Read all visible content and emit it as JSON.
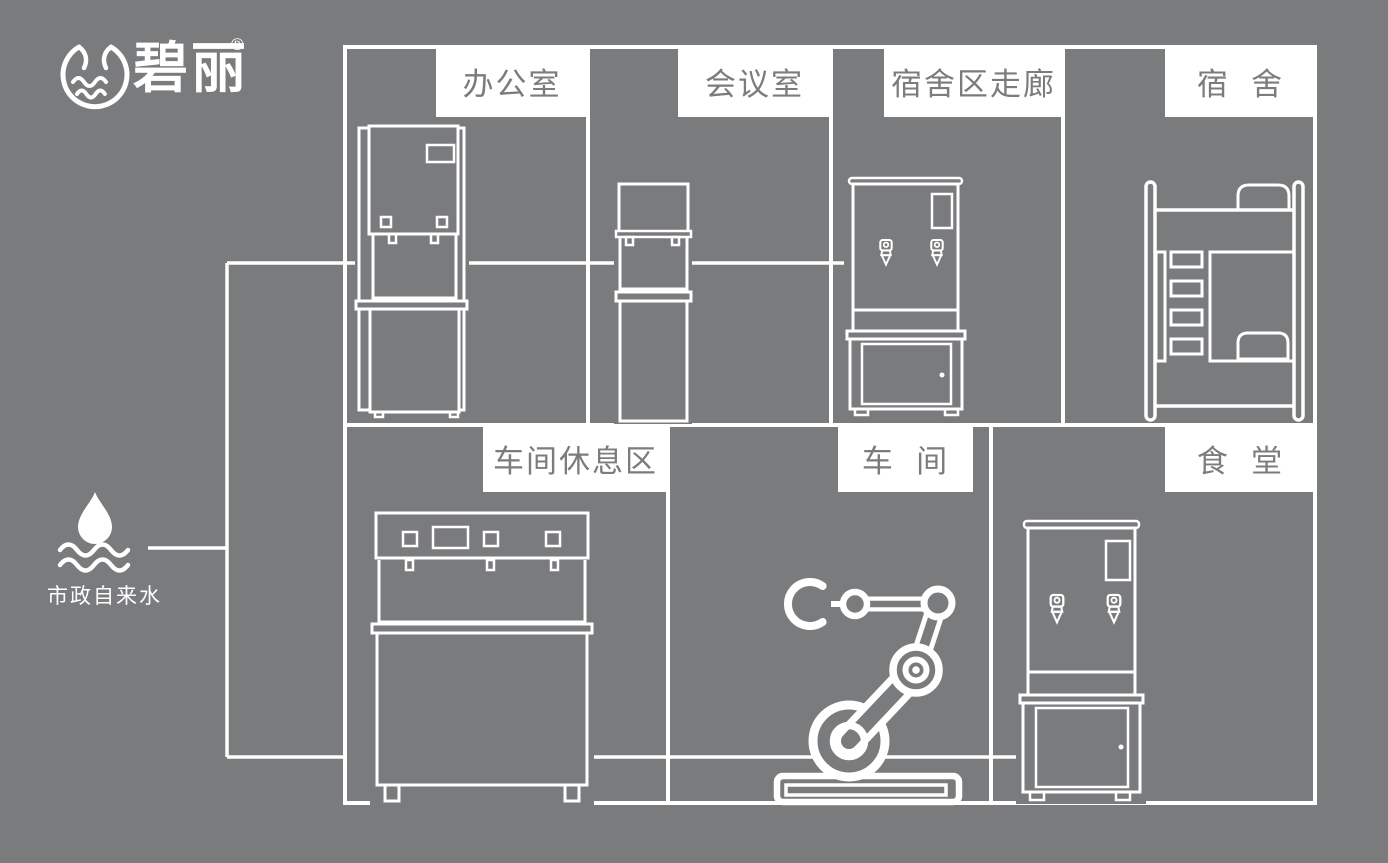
{
  "colors": {
    "background": "#7a7b7d",
    "line": "#ffffff",
    "label_bg": "#ffffff",
    "label_text": "#7b7c7e"
  },
  "logo": {
    "brand": "碧丽",
    "registered_mark": "®",
    "icon": "water-cup-logo-icon"
  },
  "water_source": {
    "label": "市政自来水",
    "icon": "water-drop-waves-icon"
  },
  "rooms": [
    {
      "id": "office",
      "label": "办公室",
      "icon": "floor-standing-dispenser-icon"
    },
    {
      "id": "meeting-room",
      "label": "会议室",
      "icon": "slim-dispenser-icon"
    },
    {
      "id": "dorm-corridor",
      "label": "宿舍区走廊",
      "icon": "water-boiler-with-stand-icon"
    },
    {
      "id": "dormitory",
      "label": "宿  舍",
      "icon": "bunk-bed-icon"
    },
    {
      "id": "workshop-rest-area",
      "label": "车间休息区",
      "icon": "wide-multi-tap-dispenser-icon"
    },
    {
      "id": "workshop",
      "label": "车  间",
      "icon": "robot-arm-icon"
    },
    {
      "id": "canteen",
      "label": "食  堂",
      "icon": "water-boiler-with-stand-icon"
    }
  ]
}
